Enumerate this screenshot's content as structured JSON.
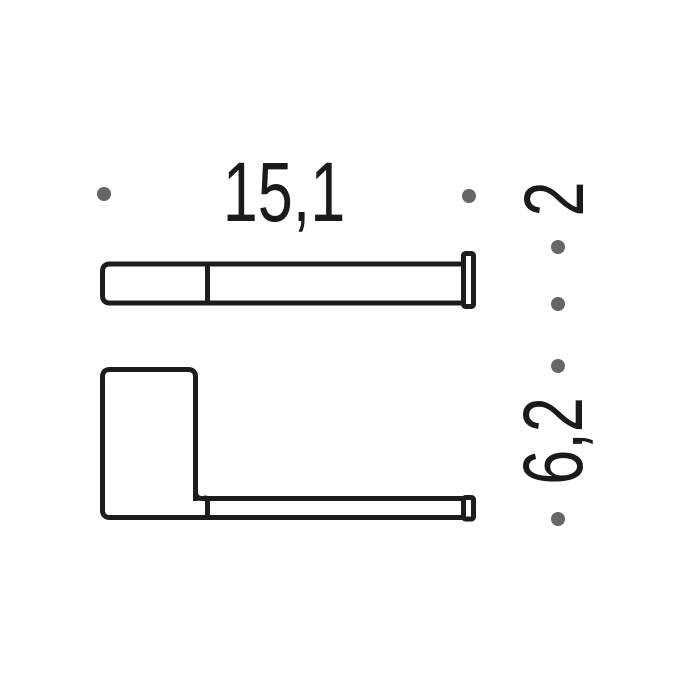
{
  "drawing": {
    "type": "technical-dimension-drawing",
    "units": "cm",
    "views": [
      {
        "id": "top-view",
        "description": "top profile of wall-mounted holder arm with wall plate at right"
      },
      {
        "id": "front-view",
        "description": "front elevation: vertical roll-holder body with long arm and wall plate at right"
      }
    ],
    "dimensions": [
      {
        "id": "width",
        "label": "15,1",
        "orientation": "horizontal"
      },
      {
        "id": "depth",
        "label": "2",
        "orientation": "vertical"
      },
      {
        "id": "height",
        "label": "6,2",
        "orientation": "vertical"
      }
    ]
  },
  "colors": {
    "line": "#1c1c1c",
    "dot": "#666666",
    "text": "#1a1a1a",
    "background": "#ffffff"
  }
}
